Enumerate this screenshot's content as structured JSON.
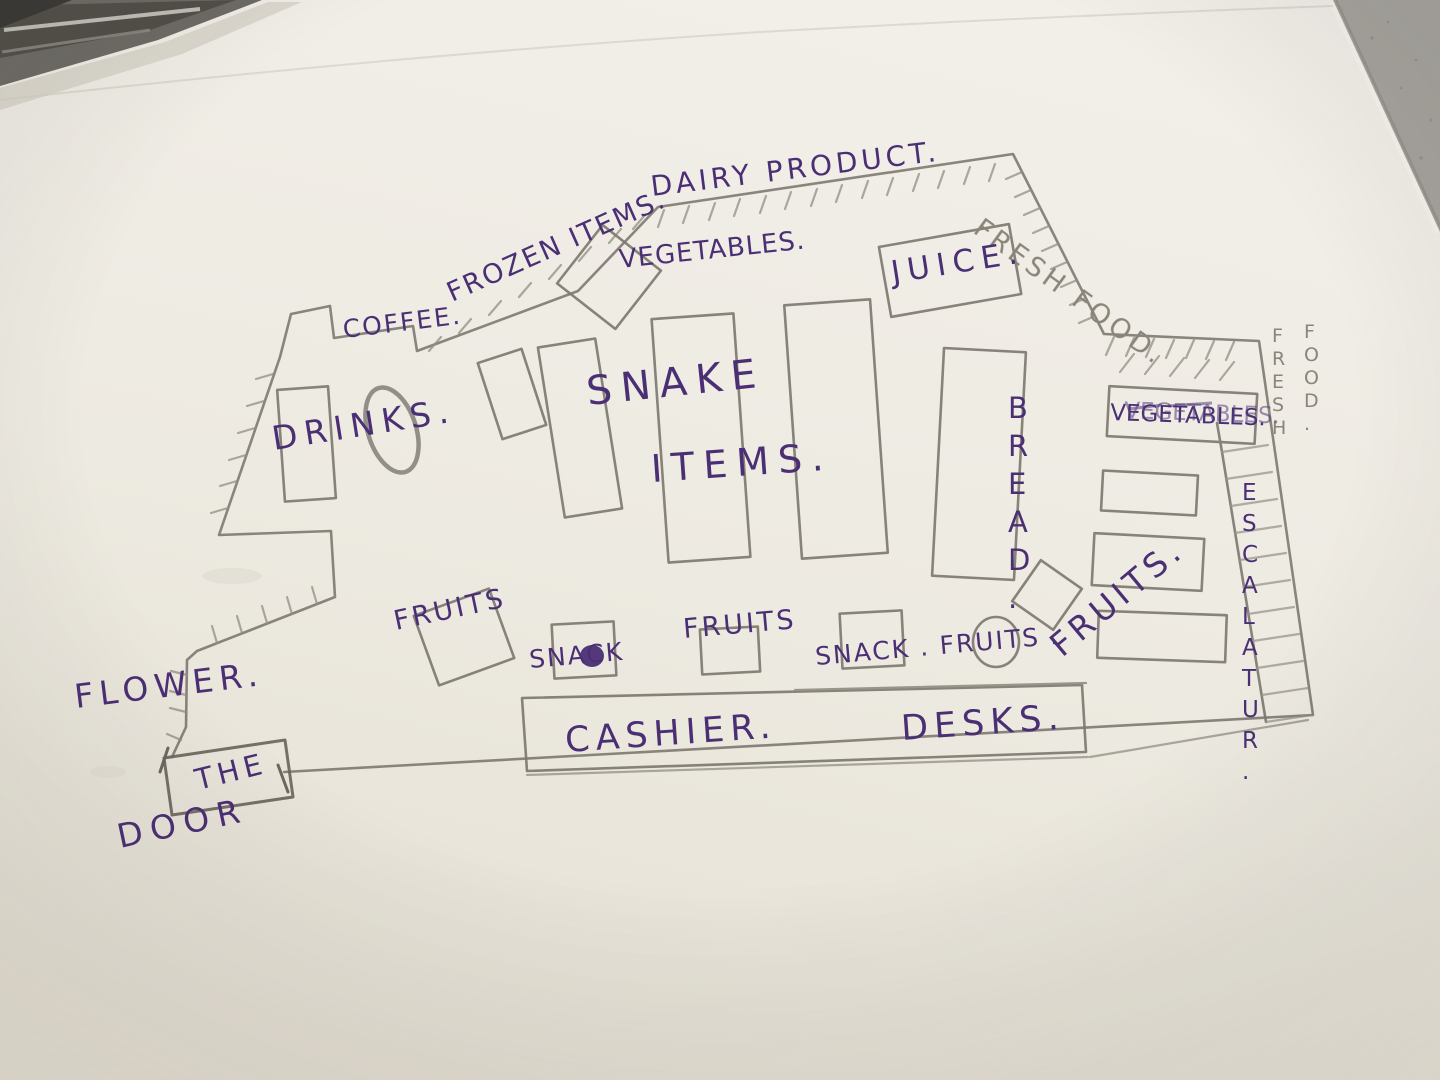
{
  "palette": {
    "ink": "#4b2f74",
    "pencil": "#857f75",
    "paper": "#ece8df",
    "table": "#a6a39e"
  },
  "floor_plan": {
    "walls": {
      "dairy_product": "DAIRY PRODUCT.",
      "frozen_items": "FROZEN ITEMS.",
      "coffee": "COFFEE.",
      "fresh_food_diagonal": "FRESH FOOD.",
      "fresh_food_vertical_1": "FRESH",
      "fresh_food_vertical_2": "FOOD."
    },
    "sections": {
      "drinks": "DRINKS.",
      "snake_line1": "SNAKE",
      "snake_line2": "ITEMS.",
      "vegetables_top": "VEGETABLES.",
      "juice": "JUICE.",
      "bread": "BREAD.",
      "vegetables_right": "VEGETABLES.",
      "fruits_right": "FRUITS.",
      "escalator": "ESCALATUR.",
      "fruits_bottom_left": "FRUITS",
      "snack_bottom_left": "SNACK",
      "fruits_bottom_center": "FRUITS",
      "snack_fruits_bottom": "SNACK . FRUITS .",
      "cashier": "CASHIER.",
      "desks": "DESKS."
    },
    "entrance": {
      "flower": "FLOWER.",
      "door_line1": "THE",
      "door_line2": "DOOR"
    }
  }
}
